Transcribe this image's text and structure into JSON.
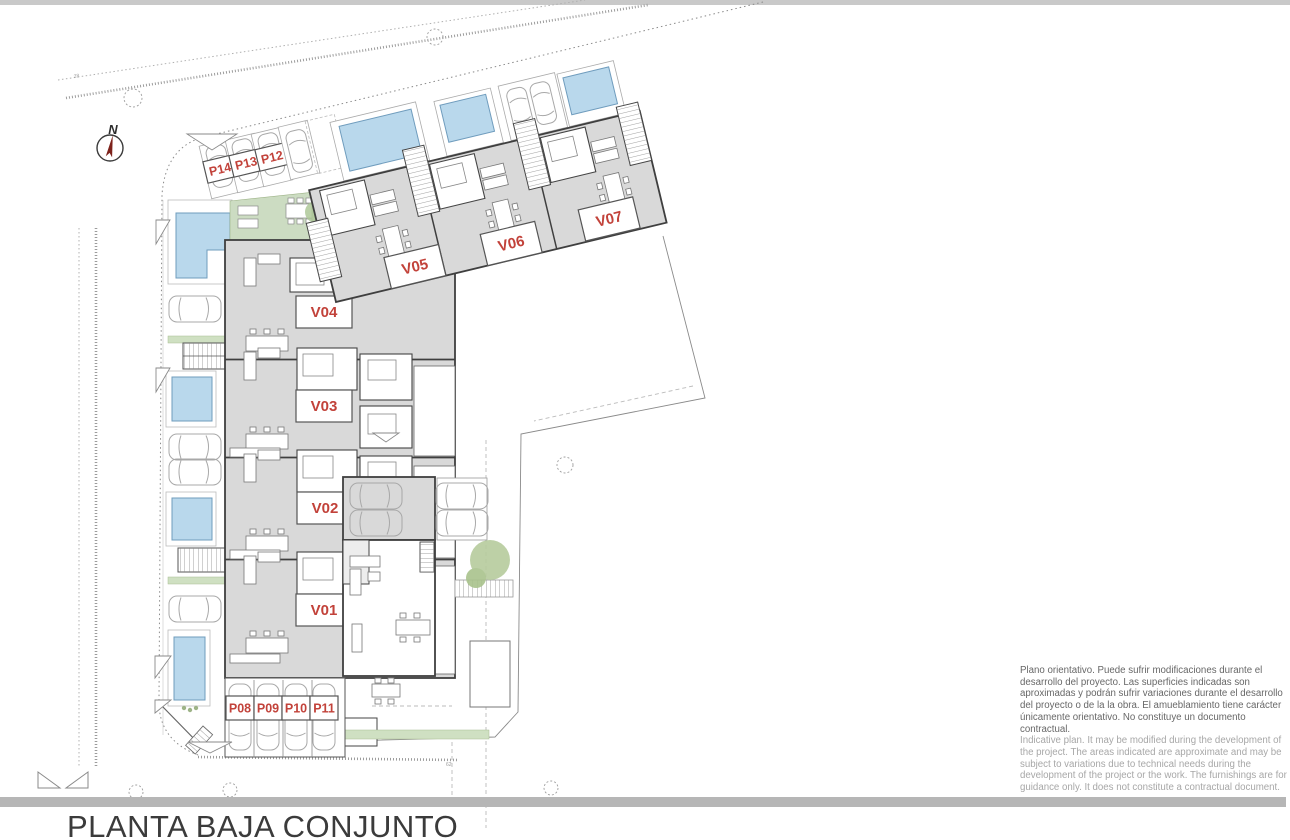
{
  "page": {
    "title": "PLANTA BAJA CONJUNTO"
  },
  "north_arrow": {
    "label": "N"
  },
  "plan": {
    "units": [
      {
        "id": "V01"
      },
      {
        "id": "V02"
      },
      {
        "id": "V03"
      },
      {
        "id": "V04"
      },
      {
        "id": "V05"
      },
      {
        "id": "V06"
      },
      {
        "id": "V07"
      }
    ],
    "parking_spots": [
      {
        "id": "P08"
      },
      {
        "id": "P09"
      },
      {
        "id": "P10"
      },
      {
        "id": "P11"
      },
      {
        "id": "P12"
      },
      {
        "id": "P13"
      },
      {
        "id": "P14"
      }
    ]
  },
  "disclaimer": {
    "es": "Plano orientativo. Puede sufrir modificaciones durante el desarrollo del proyecto. Las superficies indicadas son aproximadas y podrán sufrir variaciones durante el desarrollo del proyecto o de la la obra. El amueblamiento tiene carácter únicamente orientativo. No constituye un documento contractual.",
    "en": "Indicative plan. It may be modified during the development of the project. The areas indicated are approximate and may be subject to variations due to technical needs during the development of the project or the work. The furnishings are for guidance only. It does not constitute a contractual document."
  },
  "colors": {
    "label_red": "#c2423a",
    "pool_blue": "#b9d8ec",
    "building_gray": "#d9d9d9",
    "landscape_green": "#ccdcc2",
    "north_needle_red": "#7d221b",
    "divider_gray": "#b6b6b6"
  }
}
